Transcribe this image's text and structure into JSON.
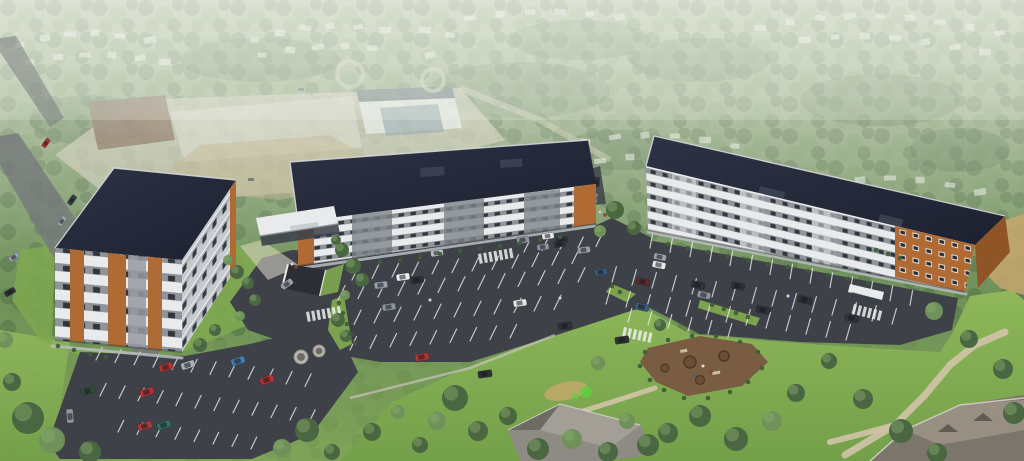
{
  "meta": {
    "title": "Aerial architectural rendering of a three-building apartment complex",
    "type": "architectural-rendering",
    "description": "Aerial rendering: three modern 5-storey apartment buildings with white, grey and wood-orange facades and dark flat roofs, large surface parking lots with cars, lawns, walking paths, a mulch amenity area, surrounded by hazy forest, suburban houses and a construction site; no legible text in image",
    "visible_text": []
  },
  "palette": {
    "treeD": "#4a6741",
    "treeL": "#70925a",
    "treeHi": "#8cab6c",
    "bushGreen": "#3f5c38",
    "lawn": "#7fa850",
    "asphalt": "#3e4248",
    "line": "#eceded",
    "roofEdge": "#d9dce1",
    "wall": "#e9eaeb",
    "grayPanel": "#959aa0",
    "bay": "#7e848a",
    "orange": "#b06a33",
    "orangeDark": "#8f5526",
    "window": "#272b33",
    "mulch": "#7a5c42",
    "mulchD": "#5c422e",
    "path": "#cfc3a6",
    "sand": "#c7a76e",
    "concrete": "#d3cfc2",
    "road": "#75787c",
    "glass": "#39404a"
  },
  "cars": [
    [
      46,
      143,
      -55,
      0.7,
      "#a83a32"
    ],
    [
      72,
      200,
      -55,
      0.75,
      "#3a3f46"
    ],
    [
      62,
      221,
      -55,
      0.75,
      "#9aa1a8"
    ],
    [
      14,
      257,
      -35,
      0.8,
      "#9aa1a8"
    ],
    [
      10,
      292,
      -30,
      0.8,
      "#2e3237"
    ],
    [
      88,
      391,
      -18,
      1,
      "#2e4d3a"
    ],
    [
      147,
      392,
      -18,
      1,
      "#b03434"
    ],
    [
      166,
      367,
      -18,
      1,
      "#b03434"
    ],
    [
      188,
      365,
      -18,
      1,
      "#a7afb6"
    ],
    [
      238,
      361,
      -18,
      1,
      "#4a79a8"
    ],
    [
      267,
      380,
      -18,
      1,
      "#b03434"
    ],
    [
      145,
      426,
      -18,
      1,
      "#ad3a3a"
    ],
    [
      164,
      425,
      -18,
      1,
      "#2f6f62"
    ],
    [
      70,
      416,
      -95,
      1,
      "#8d949b"
    ],
    [
      287,
      284,
      -35,
      0.9,
      "#9aa1a8"
    ],
    [
      381,
      285,
      -8,
      0.95,
      "#9aa1a8"
    ],
    [
      389,
      307,
      -8,
      0.95,
      "#8d949b"
    ],
    [
      403,
      277,
      -8,
      0.95,
      "#f0f0f0"
    ],
    [
      417,
      280,
      -8,
      0.95,
      "#2e3237"
    ],
    [
      437,
      253,
      -8,
      0.9,
      "#b9bfc5"
    ],
    [
      422,
      357,
      -8,
      1,
      "#b03434"
    ],
    [
      485,
      374,
      -8,
      1,
      "#2e3237"
    ],
    [
      520,
      303,
      -8,
      0.95,
      "#e8e8e8"
    ],
    [
      523,
      240,
      -8,
      0.9,
      "#8d949b"
    ],
    [
      548,
      236,
      -8,
      0.85,
      "#e8e8e8"
    ],
    [
      562,
      240,
      -8,
      0.85,
      "#2e3237"
    ],
    [
      584,
      250,
      -8,
      0.9,
      "#9aa1a8"
    ],
    [
      601,
      272,
      -8,
      0.9,
      "#3d5a78"
    ],
    [
      565,
      326,
      -8,
      1,
      "#2e3237"
    ],
    [
      622,
      340,
      -8,
      1,
      "#2e3237"
    ],
    [
      560,
      244,
      -8,
      0.85,
      "#2e3237"
    ],
    [
      543,
      247,
      -8,
      0.85,
      "#8d949b"
    ],
    [
      597,
      182,
      -85,
      0.7,
      "#2e3237"
    ],
    [
      595,
      198,
      -85,
      0.7,
      "#8d949b"
    ],
    [
      660,
      257,
      12,
      0.9,
      "#9aa1a8"
    ],
    [
      698,
      285,
      12,
      0.95,
      "#2e3237"
    ],
    [
      738,
      286,
      12,
      0.95,
      "#2e3237"
    ],
    [
      643,
      282,
      12,
      0.95,
      "#5a2e2e"
    ],
    [
      642,
      307,
      12,
      1,
      "#3d5a78"
    ],
    [
      763,
      310,
      12,
      1,
      "#2e3237"
    ],
    [
      805,
      300,
      12,
      1,
      "#2e3237"
    ],
    [
      659,
      265,
      12,
      0.95,
      "#e8e8e8"
    ],
    [
      704,
      295,
      12,
      0.95,
      "#8d949b"
    ],
    [
      852,
      318,
      14,
      1,
      "#30343a"
    ]
  ],
  "stall_rows": [
    [
      352,
      280,
      20,
      -1.5,
      12,
      15,
      -64
    ],
    [
      338,
      300,
      20,
      -1.5,
      13,
      16,
      -64
    ],
    [
      334,
      326,
      20,
      -1.5,
      12,
      16,
      -64
    ],
    [
      350,
      350,
      20,
      -1.5,
      9,
      15,
      -64
    ],
    [
      524,
      252,
      18,
      -1.4,
      5,
      12,
      -64
    ],
    [
      96,
      360,
      19,
      2.4,
      12,
      14,
      -64
    ],
    [
      100,
      396,
      19,
      2.4,
      12,
      14,
      -64
    ],
    [
      118,
      432,
      19,
      2.4,
      8,
      13,
      -64
    ],
    [
      650,
      248,
      20,
      4.4,
      14,
      15,
      -80
    ],
    [
      612,
      282,
      20,
      3.0,
      15,
      16,
      -74
    ],
    [
      606,
      304,
      20,
      3.0,
      13,
      16,
      -74
    ],
    [
      628,
      322,
      20,
      3.0,
      6,
      14,
      -74
    ]
  ],
  "crosswalks": [
    [
      306,
      312,
      -10,
      7
    ],
    [
      478,
      254,
      -10,
      7
    ],
    [
      854,
      304,
      14,
      6
    ],
    [
      624,
      327,
      12,
      6
    ]
  ],
  "trees": [
    [
      28,
      418,
      16,
      "d"
    ],
    [
      52,
      440,
      13,
      "l"
    ],
    [
      90,
      452,
      11,
      "d"
    ],
    [
      12,
      382,
      9,
      "d"
    ],
    [
      5,
      340,
      8,
      "l"
    ],
    [
      237,
      272,
      7,
      "d"
    ],
    [
      248,
      283,
      6,
      "d"
    ],
    [
      228,
      260,
      5,
      "l"
    ],
    [
      255,
      300,
      6,
      "d"
    ],
    [
      240,
      316,
      5,
      "l"
    ],
    [
      215,
      330,
      6,
      "d"
    ],
    [
      200,
      345,
      7,
      "d"
    ],
    [
      342,
      250,
      7,
      "d"
    ],
    [
      353,
      266,
      8,
      "d"
    ],
    [
      336,
      240,
      5,
      "d"
    ],
    [
      362,
      280,
      7,
      "d"
    ],
    [
      345,
      295,
      5,
      "l"
    ],
    [
      338,
      320,
      7,
      "d"
    ],
    [
      346,
      336,
      6,
      "d"
    ],
    [
      307,
      430,
      12,
      "d"
    ],
    [
      282,
      448,
      9,
      "l"
    ],
    [
      332,
      452,
      8,
      "d"
    ],
    [
      372,
      432,
      9,
      "d"
    ],
    [
      398,
      412,
      7,
      "l"
    ],
    [
      455,
      398,
      13,
      "d"
    ],
    [
      437,
      421,
      9,
      "l"
    ],
    [
      478,
      431,
      10,
      "d"
    ],
    [
      420,
      445,
      8,
      "d"
    ],
    [
      508,
      416,
      9,
      "d"
    ],
    [
      538,
      449,
      11,
      "d"
    ],
    [
      572,
      439,
      10,
      "l"
    ],
    [
      608,
      452,
      10,
      "d"
    ],
    [
      648,
      445,
      11,
      "d"
    ],
    [
      627,
      421,
      8,
      "l"
    ],
    [
      668,
      433,
      10,
      "d"
    ],
    [
      700,
      416,
      11,
      "d"
    ],
    [
      736,
      439,
      12,
      "d"
    ],
    [
      772,
      421,
      10,
      "l"
    ],
    [
      796,
      393,
      9,
      "d"
    ],
    [
      829,
      361,
      8,
      "d"
    ],
    [
      863,
      399,
      10,
      "d"
    ],
    [
      901,
      431,
      12,
      "d"
    ],
    [
      937,
      453,
      10,
      "d"
    ],
    [
      934,
      311,
      9,
      "l"
    ],
    [
      969,
      339,
      9,
      "d"
    ],
    [
      1003,
      369,
      10,
      "d"
    ],
    [
      1014,
      413,
      11,
      "d"
    ],
    [
      598,
      363,
      7,
      "l"
    ],
    [
      615,
      210,
      9,
      "d"
    ],
    [
      634,
      228,
      7,
      "d"
    ],
    [
      600,
      231,
      6,
      "l"
    ],
    [
      660,
      325,
      6,
      "d"
    ]
  ],
  "bushes": [
    [
      380,
      262
    ],
    [
      400,
      260
    ],
    [
      420,
      257
    ],
    [
      440,
      254
    ],
    [
      460,
      251
    ],
    [
      480,
      248
    ],
    [
      500,
      246
    ],
    [
      520,
      243
    ],
    [
      540,
      240
    ],
    [
      560,
      237
    ],
    [
      668,
      244
    ],
    [
      688,
      248
    ],
    [
      708,
      252
    ],
    [
      728,
      256
    ],
    [
      748,
      260
    ],
    [
      768,
      264
    ],
    [
      788,
      267
    ],
    [
      808,
      271
    ],
    [
      828,
      275
    ],
    [
      848,
      279
    ],
    [
      868,
      283
    ],
    [
      339,
      303
    ],
    [
      343,
      313
    ],
    [
      347,
      324
    ],
    [
      351,
      334
    ],
    [
      355,
      343
    ],
    [
      712,
      305
    ],
    [
      724,
      309
    ],
    [
      736,
      313
    ],
    [
      748,
      317
    ],
    [
      876,
      250
    ],
    [
      888,
      254
    ],
    [
      900,
      258
    ],
    [
      620,
      292
    ],
    [
      612,
      286
    ],
    [
      58,
      346
    ],
    [
      74,
      350
    ],
    [
      90,
      354
    ],
    [
      106,
      357
    ],
    [
      645,
      352
    ],
    [
      640,
      366
    ],
    [
      650,
      380
    ],
    [
      664,
      390
    ],
    [
      684,
      398
    ],
    [
      708,
      398
    ],
    [
      730,
      392
    ],
    [
      748,
      382
    ],
    [
      762,
      368
    ],
    [
      758,
      352
    ],
    [
      740,
      342
    ],
    [
      716,
      336
    ],
    [
      692,
      336
    ],
    [
      668,
      340
    ]
  ],
  "bg_houses": [
    [
      20,
      45
    ],
    [
      45,
      38
    ],
    [
      70,
      34
    ],
    [
      95,
      33
    ],
    [
      120,
      36
    ],
    [
      150,
      40
    ],
    [
      30,
      62
    ],
    [
      58,
      57
    ],
    [
      85,
      55
    ],
    [
      112,
      55
    ],
    [
      140,
      58
    ],
    [
      165,
      62
    ],
    [
      255,
      40
    ],
    [
      280,
      33
    ],
    [
      305,
      28
    ],
    [
      330,
      26
    ],
    [
      358,
      27
    ],
    [
      385,
      30
    ],
    [
      262,
      55
    ],
    [
      290,
      50
    ],
    [
      318,
      47
    ],
    [
      345,
      46
    ],
    [
      372,
      48
    ],
    [
      425,
      30
    ],
    [
      450,
      35
    ],
    [
      430,
      55
    ],
    [
      470,
      18
    ],
    [
      500,
      14
    ],
    [
      530,
      12
    ],
    [
      560,
      12
    ],
    [
      590,
      14
    ],
    [
      620,
      17
    ],
    [
      760,
      28
    ],
    [
      790,
      22
    ],
    [
      820,
      18
    ],
    [
      850,
      16
    ],
    [
      880,
      16
    ],
    [
      910,
      18
    ],
    [
      940,
      22
    ],
    [
      970,
      27
    ],
    [
      1000,
      33
    ],
    [
      805,
      40
    ],
    [
      835,
      37
    ],
    [
      865,
      36
    ],
    [
      895,
      38
    ],
    [
      925,
      42
    ],
    [
      955,
      47
    ],
    [
      985,
      52
    ],
    [
      555,
      150
    ],
    [
      585,
      142
    ],
    [
      615,
      137
    ],
    [
      645,
      135
    ],
    [
      675,
      136
    ],
    [
      705,
      140
    ],
    [
      735,
      146
    ],
    [
      570,
      168
    ],
    [
      600,
      161
    ],
    [
      630,
      157
    ],
    [
      660,
      156
    ],
    [
      690,
      159
    ],
    [
      830,
      185
    ],
    [
      860,
      180
    ],
    [
      890,
      178
    ],
    [
      920,
      180
    ],
    [
      950,
      185
    ],
    [
      980,
      192
    ],
    [
      845,
      205
    ],
    [
      875,
      200
    ],
    [
      905,
      200
    ],
    [
      935,
      204
    ],
    [
      965,
      210
    ],
    [
      995,
      218
    ],
    [
      862,
      240
    ],
    [
      892,
      238
    ],
    [
      922,
      242
    ],
    [
      952,
      248
    ]
  ],
  "people": [
    [
      600,
      212,
      "#d6d6d6"
    ],
    [
      605,
      215,
      "#8a4a3a"
    ],
    [
      560,
      298,
      "#d6d6d6"
    ],
    [
      788,
      296,
      "#d6d6d6"
    ],
    [
      792,
      299,
      "#33507a"
    ],
    [
      292,
      264,
      "#d6d6d6"
    ],
    [
      296,
      267,
      "#8a4a3a"
    ],
    [
      703,
      366,
      "#dcdcdc"
    ],
    [
      711,
      372,
      "#8a4a3a"
    ],
    [
      695,
      375,
      "#4a6a8a"
    ],
    [
      430,
      300,
      "#d6d6d6"
    ]
  ]
}
